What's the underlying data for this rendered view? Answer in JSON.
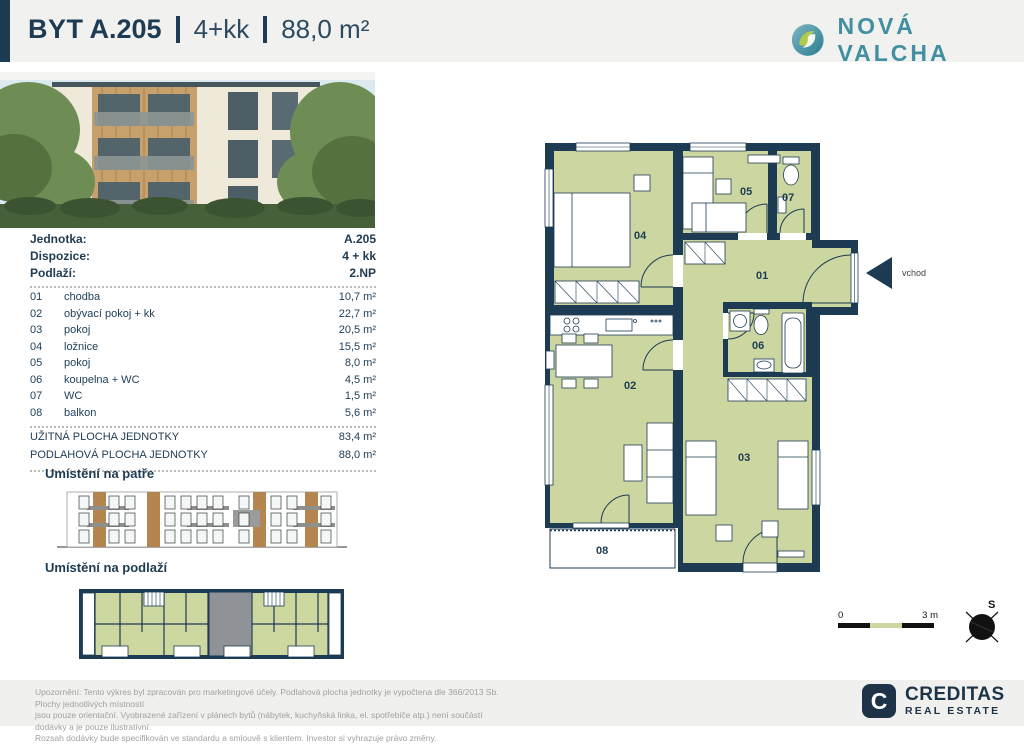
{
  "header": {
    "unit_label": "BYT",
    "unit_number": "A.205",
    "layout": "4+kk",
    "area": "88,0 m²",
    "brand": "NOVÁ VALCHA"
  },
  "info": {
    "rows": [
      {
        "label": "Jednotka:",
        "value": "A.205"
      },
      {
        "label": "Dispozice:",
        "value": "4 + kk"
      },
      {
        "label": "Podlaží:",
        "value": "2.NP"
      }
    ],
    "rooms": [
      {
        "num": "01",
        "name": "chodba",
        "area": "10,7 m²"
      },
      {
        "num": "02",
        "name": "obývací pokoj + kk",
        "area": "22,7 m²"
      },
      {
        "num": "03",
        "name": "pokoj",
        "area": "20,5 m²"
      },
      {
        "num": "04",
        "name": "ložnice",
        "area": "15,5 m²"
      },
      {
        "num": "05",
        "name": "pokoj",
        "area": "8,0 m²"
      },
      {
        "num": "06",
        "name": "koupelna + WC",
        "area": "4,5 m²"
      },
      {
        "num": "07",
        "name": "WC",
        "area": "1,5 m²"
      },
      {
        "num": "08",
        "name": "balkon",
        "area": "5,6 m²"
      }
    ],
    "totals": [
      {
        "label": "UŽITNÁ PLOCHA JEDNOTKY",
        "area": "83,4 m²"
      },
      {
        "label": "PODLAHOVÁ PLOCHA JEDNOTKY",
        "area": "88,0 m²"
      }
    ]
  },
  "sections": {
    "floor_title": "Umístění na patře",
    "level_title": "Umístění na podlaží"
  },
  "plan": {
    "labels": {
      "r01": "01",
      "r02": "02",
      "r03": "03",
      "r04": "04",
      "r05": "05",
      "r06": "06",
      "r07": "07",
      "r08": "08"
    },
    "entrance": "vchod"
  },
  "scale": {
    "start": "0",
    "end": "3 m"
  },
  "compass": {
    "label": "S"
  },
  "colors": {
    "wall_navy": "#1d3b52",
    "room_green": "#ccd6a0",
    "brand_teal": "#418fa1",
    "creditas_navy": "#1d3347"
  },
  "footer": {
    "line1": "Upozornění: Tento výkres byl zpracován pro marketingové účely. Podlahová plocha jednotky je vypočtena dle 366/2013 Sb. Plochy jednotlivých místností",
    "line2": "jsou pouze orientační. Vyobrazené zařízení v plánech bytů (nábytek, kuchyňská linka, el. spotřebiče atp.) není součástí dodávky a je pouze ilustrativní.",
    "line3": "Rozsah dodávky bude specifikován ve standardu a smlouvě s klientem. Investor si vyhrazuje právo změny.",
    "brand_name": "CREDITAS",
    "brand_sub": "REAL ESTATE"
  }
}
